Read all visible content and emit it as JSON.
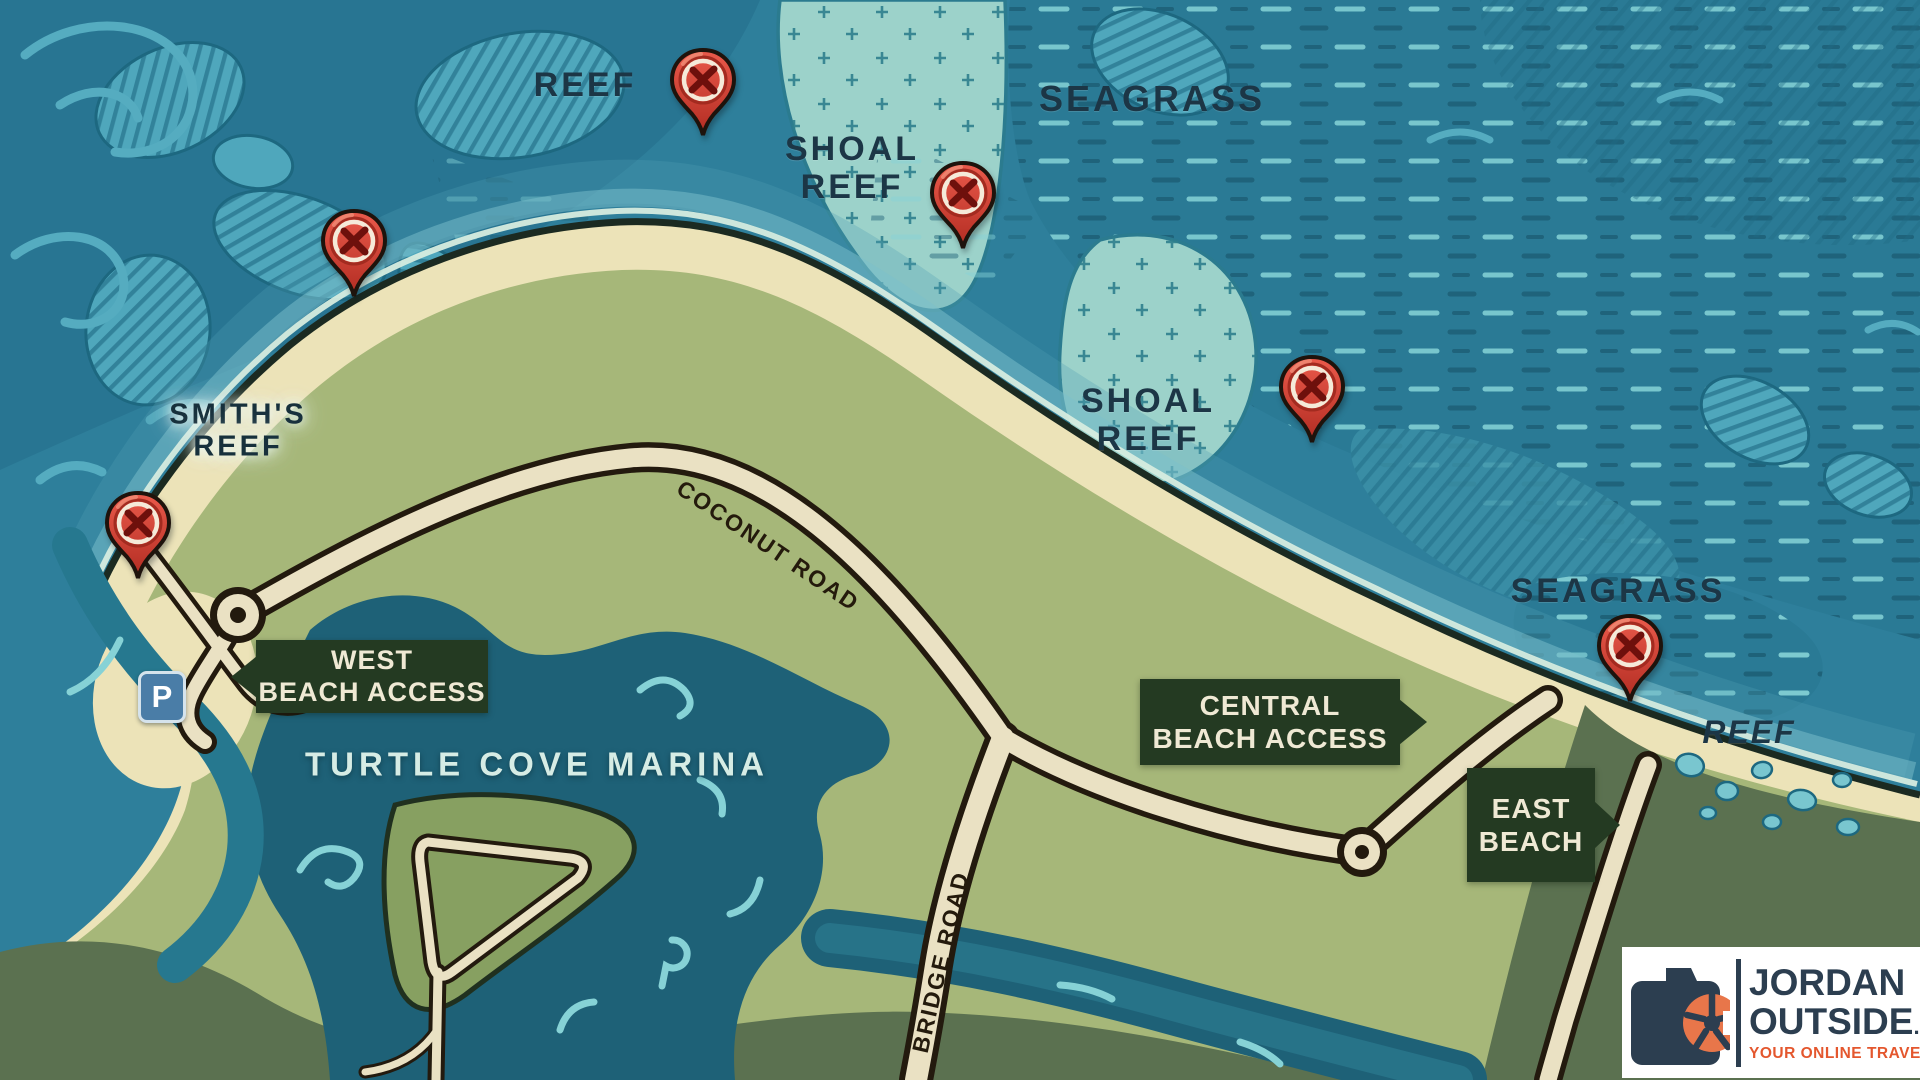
{
  "map": {
    "labels": {
      "reef_northwest": "REEF",
      "shoal_reef_north": [
        "SHOAL",
        "REEF"
      ],
      "seagrass_north": "SEAGRASS",
      "shoal_reef_central": [
        "SHOAL",
        "REEF"
      ],
      "smiths_reef": [
        "SMITH'S",
        "REEF"
      ],
      "seagrass_east": "SEAGRASS",
      "reef_southeast": "REEF",
      "turtle_cove_marina": "TURTLE COVE MARINA"
    },
    "roads": {
      "coconut_road": "COCONUT ROAD",
      "bridge_road": "BRIDGE ROAD"
    },
    "signs": {
      "west": [
        "WEST",
        "BEACH ACCESS"
      ],
      "central": [
        "CENTRAL",
        "BEACH ACCESS"
      ],
      "east": [
        "EAST",
        "BEACH",
        "ACCESS"
      ]
    },
    "parking_label": "P",
    "markers": [
      {
        "x": 703,
        "y": 87
      },
      {
        "x": 963,
        "y": 200
      },
      {
        "x": 354,
        "y": 248
      },
      {
        "x": 1312,
        "y": 394
      },
      {
        "x": 138,
        "y": 530
      },
      {
        "x": 1630,
        "y": 653
      }
    ],
    "colors": {
      "water": "#2e7f9b",
      "deep_water": "#246d8a",
      "reef_patch": "#4fa7bc",
      "shoal_patch": "#9cd2ca",
      "sand": "#ece3b8",
      "land": "#a6b779",
      "land_dark": "#5b7150",
      "marina": "#1e6177",
      "road": "#eae1c3",
      "road_outline": "#231a0e",
      "sign_green": "#243a22",
      "pin_red": "#d6453c"
    }
  },
  "logo": {
    "brand_top": "JORDAN",
    "brand_bottom": "OUTSIDE",
    "tld": ".COM",
    "tagline": "YOUR ONLINE TRAVEL GUIDE"
  }
}
